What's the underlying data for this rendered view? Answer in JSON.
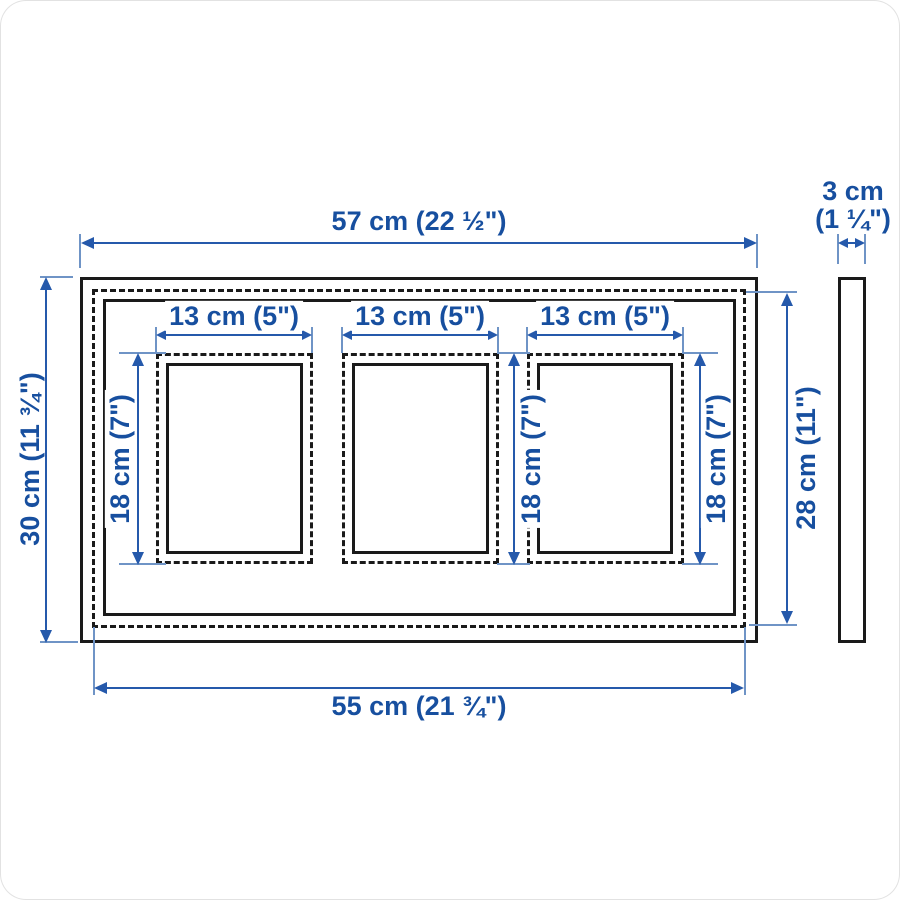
{
  "diagram": {
    "type": "product-dimension-diagram",
    "subject": "triple-opening picture frame, front view with side profile",
    "labels": {
      "overall_width": "57 cm (22 ½\")",
      "overall_height": "30 cm (11 ¾\")",
      "back_width": "55 cm (21 ¾\")",
      "back_height": "28 cm (11\")",
      "depth_cm": "3 cm",
      "depth_inch": "(1 ¼\")",
      "opening_width": "13 cm (5\")",
      "opening_height": "18 cm (7\")"
    },
    "colors": {
      "line": "#1a1a1a",
      "dim": "#2559ab",
      "ext": "#6f94c6",
      "text": "#174f9f"
    }
  }
}
